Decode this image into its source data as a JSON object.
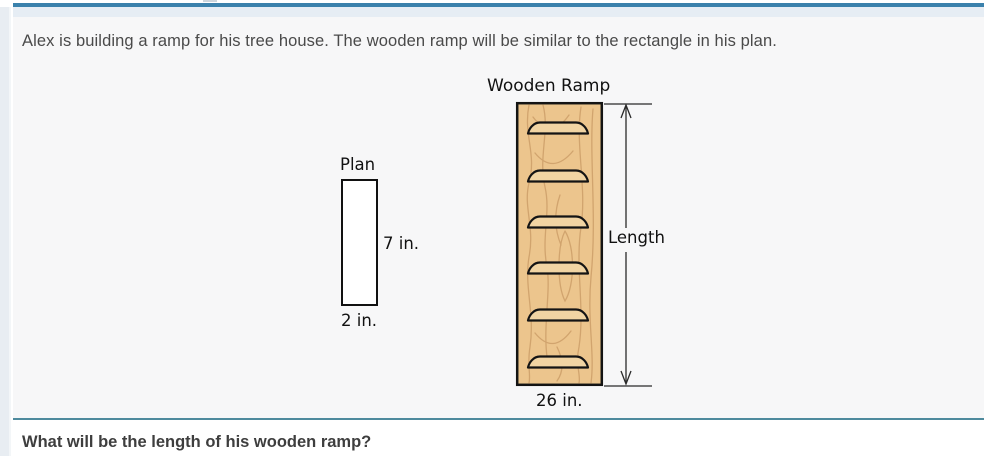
{
  "problem": {
    "statement": "Alex is building a ramp for his tree house. The wooden ramp will be similar to the rectangle in his plan.",
    "question": "What will be the length of his wooden ramp?"
  },
  "diagram": {
    "plan": {
      "title": "Plan",
      "height_label": "7 in.",
      "width_label": "2 in."
    },
    "ramp": {
      "title": "Wooden Ramp",
      "length_label": "Length",
      "base_label": "26 in."
    }
  },
  "colors": {
    "top_accent_line": "#3a81ac",
    "header_band": "#e6edf4",
    "card_background": "#f7f7f8",
    "left_strip": "#e8edf2",
    "section_divider": "#4e8a9d",
    "wood_fill": "#ecc58d",
    "wood_grain": "#d1a46e",
    "tread_fill": "#f1d4a3",
    "outline": "#141414",
    "body_text": "#4a4a4a",
    "question_text": "#3e3e3e"
  }
}
